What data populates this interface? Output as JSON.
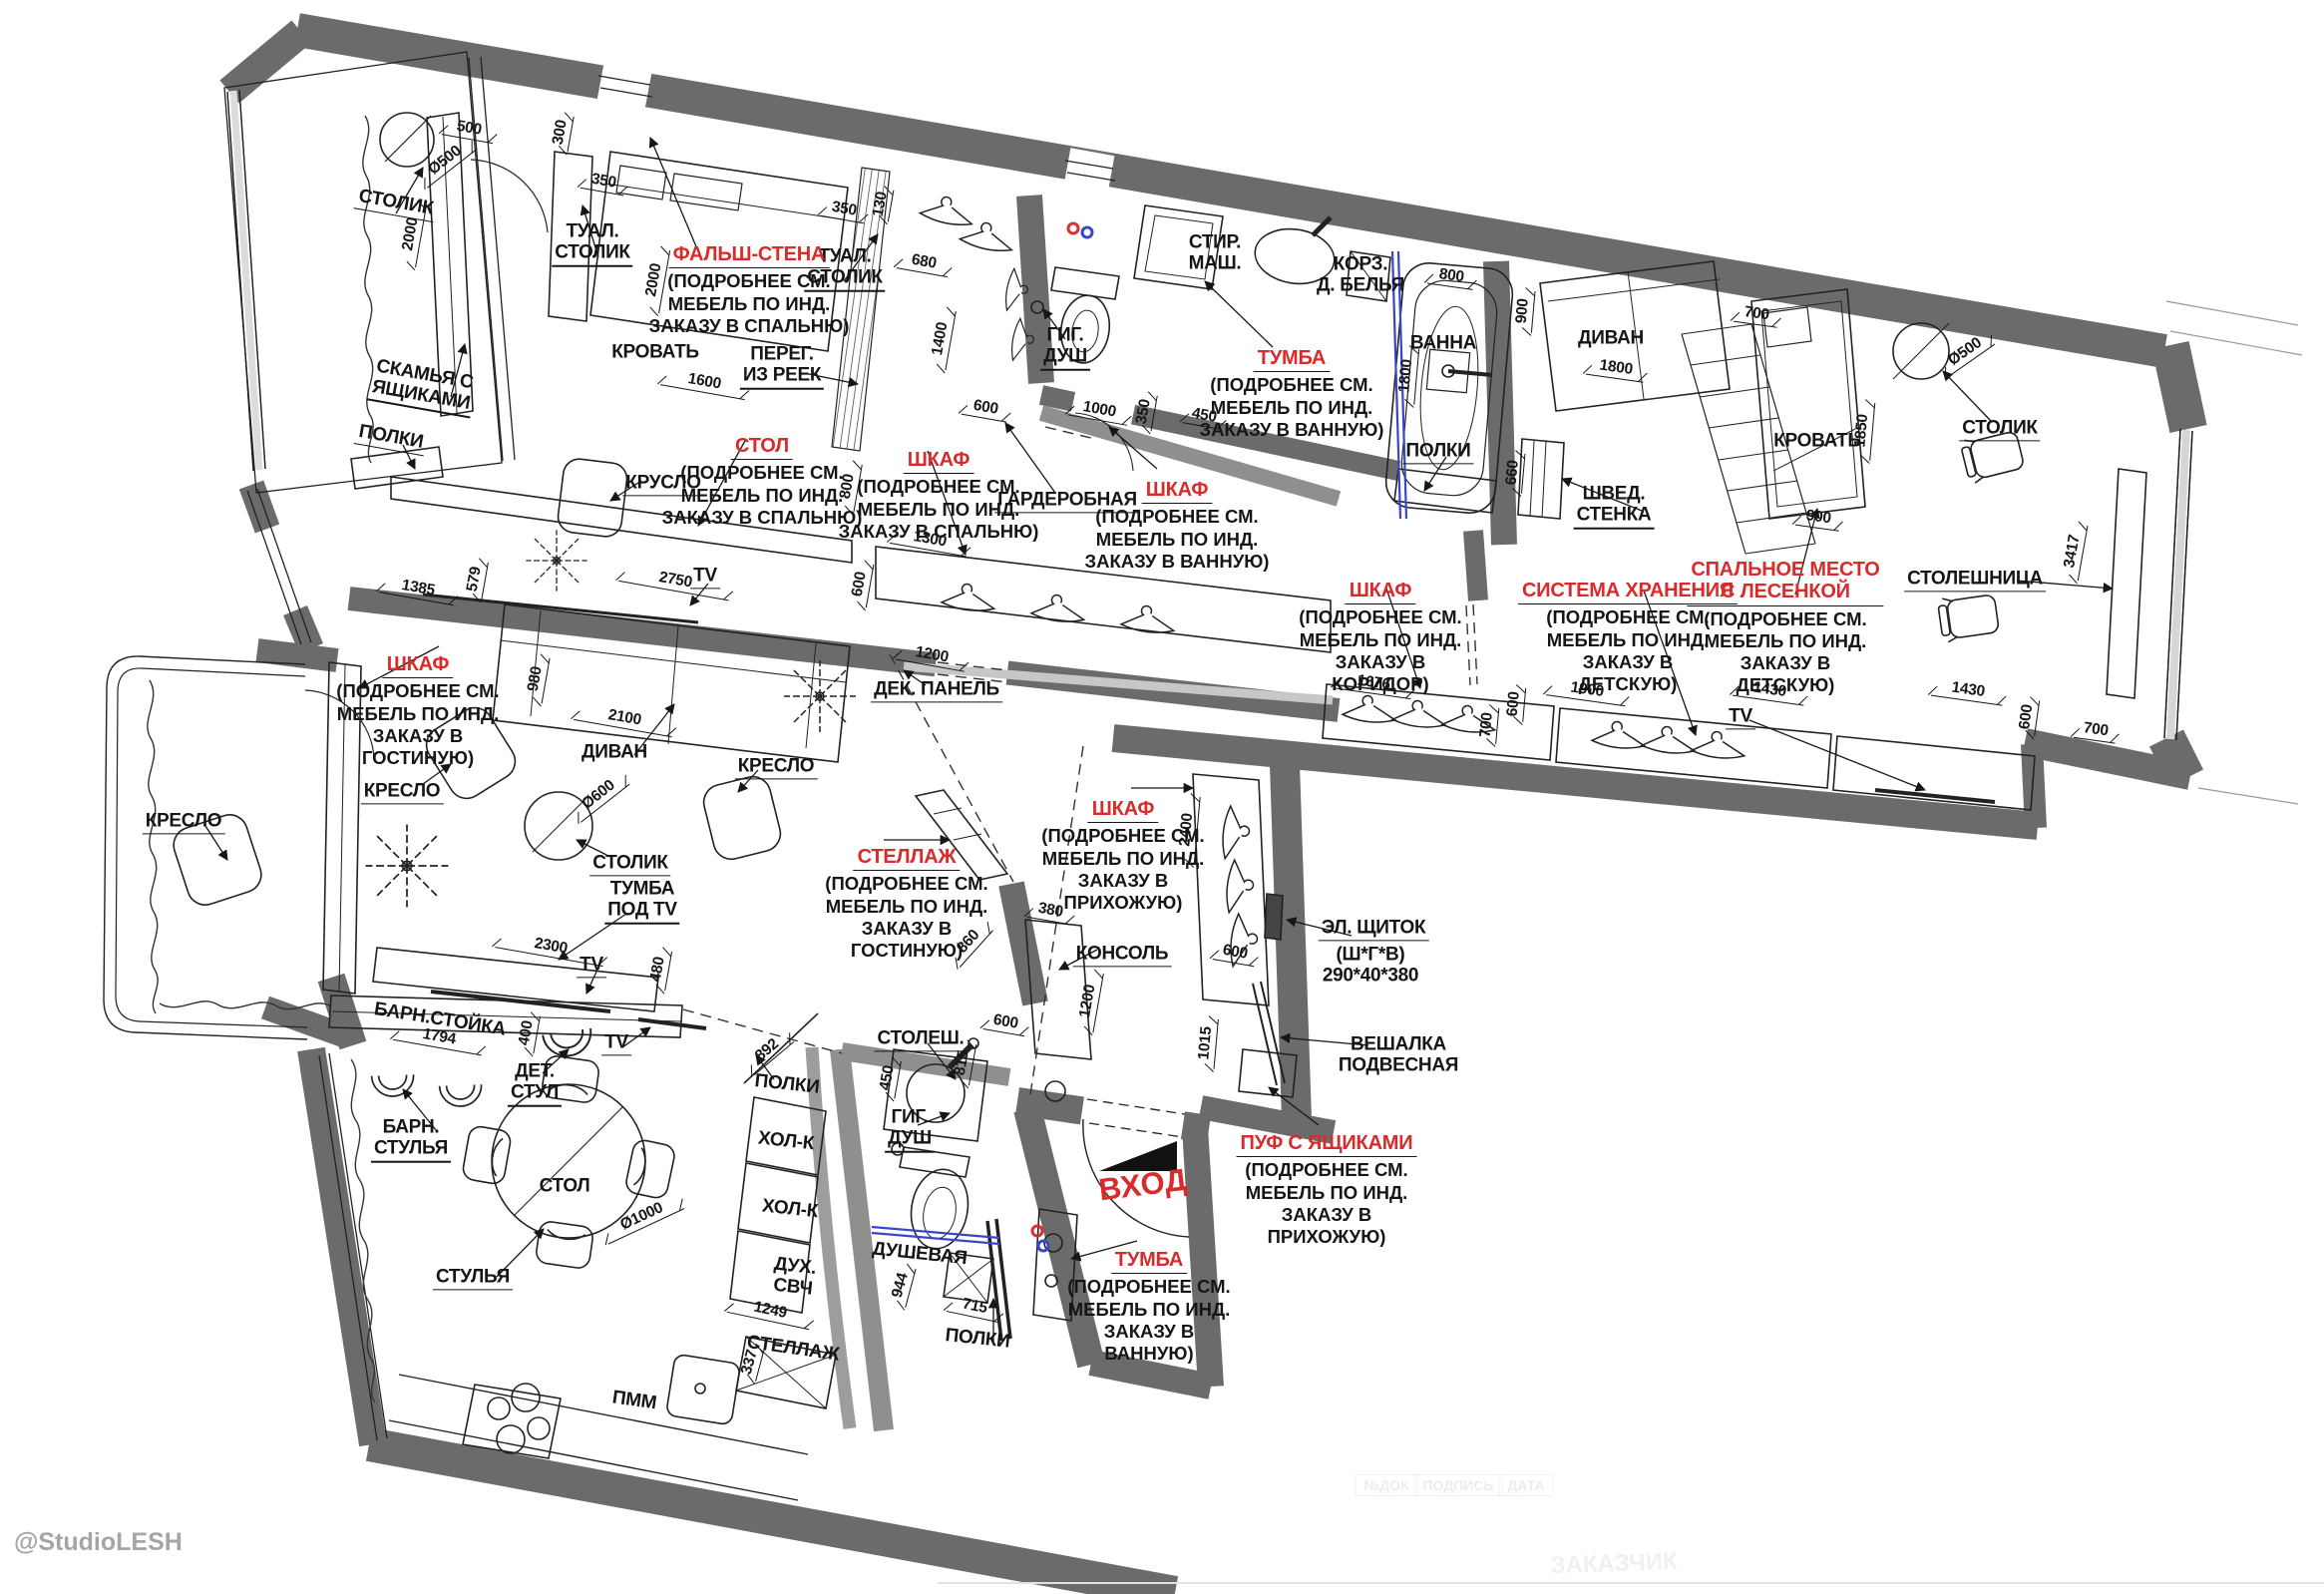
{
  "meta": {
    "credit": "@StudioLESH",
    "entrance": "ВХОД"
  },
  "colors": {
    "wall": "#6b6b6b",
    "wall_light": "#9d9d9d",
    "accent_red": "#d92b2b",
    "glass_blue": "#3a46c8",
    "ink": "#161616",
    "supply_red": "#d93030",
    "supply_blue": "#3a46c8"
  },
  "labels": [
    {
      "name": "balcony-table",
      "text": "СТОЛИК"
    },
    {
      "name": "bench-with-drawers",
      "text": "СКАМЬЯ С\nЯЩИКАМИ"
    },
    {
      "name": "balcony-shelves",
      "text": "ПОЛКИ"
    },
    {
      "name": "vanity-left",
      "text": "ТУАЛ.\nСТОЛИК"
    },
    {
      "name": "bed-main",
      "text": "КРОВАТЬ"
    },
    {
      "name": "slat-partition",
      "text": "ПЕРЕГ.\nИЗ РЕЕК"
    },
    {
      "name": "vanity-right",
      "text": "ТУАЛ.\nСТОЛИК"
    },
    {
      "name": "armchair-bedroom",
      "text": "КРУСЛО"
    },
    {
      "name": "tv-bedroom",
      "text": "TV"
    },
    {
      "name": "deco-panel",
      "text": "ДЕК. ПАНЕЛЬ"
    },
    {
      "name": "hyg-shower-top",
      "text": "ГИГ.\nДУШ"
    },
    {
      "name": "washing-machine",
      "text": "СТИР.\nМАШ."
    },
    {
      "name": "laundry-basket",
      "text": "КОРЗ.\nД. БЕЛЬЯ"
    },
    {
      "name": "bathtub",
      "text": "ВАННА"
    },
    {
      "name": "bath-shelves",
      "text": "ПОЛКИ"
    },
    {
      "name": "walk-in-closet",
      "text": "ГАРДЕРОБНАЯ"
    },
    {
      "name": "sofa-kids",
      "text": "ДИВАН"
    },
    {
      "name": "bed-kids",
      "text": "КРОВАТЬ"
    },
    {
      "name": "table-kids",
      "text": "СТОЛИК"
    },
    {
      "name": "swedish-wall",
      "text": "ШВЕД.\nСТЕНКА"
    },
    {
      "name": "desk-kids",
      "text": "СТОЛЕШНИЦА"
    },
    {
      "name": "tv-kids",
      "text": "TV"
    },
    {
      "name": "armchair-balcony",
      "text": "КРЕСЛО"
    },
    {
      "name": "armchair-living-left",
      "text": "КРЕСЛО"
    },
    {
      "name": "armchair-living-right",
      "text": "КРЕСЛО"
    },
    {
      "name": "sofa-living",
      "text": "ДИВАН"
    },
    {
      "name": "coffee-table",
      "text": "СТОЛИК"
    },
    {
      "name": "tv-stand",
      "text": "ТУМБА\nПОД TV"
    },
    {
      "name": "tv-living",
      "text": "TV"
    },
    {
      "name": "console",
      "text": "КОНСОЛЬ"
    },
    {
      "name": "counter-bath",
      "text": "СТОЛЕШ."
    },
    {
      "name": "hyg-shower-bottom",
      "text": "ГИГ.\nДУШ"
    },
    {
      "name": "el-panel-title",
      "text": "ЭЛ. ЩИТОК"
    },
    {
      "name": "el-panel-spec",
      "text": "(Ш*Г*В)\n290*40*380"
    },
    {
      "name": "wall-hanger",
      "text": "ВЕШАЛКА\nПОДВЕСНАЯ"
    },
    {
      "name": "bar-counter",
      "text": "БАРН.СТОЙКА"
    },
    {
      "name": "bar-stools",
      "text": "БАРН.\nСТУЛЬЯ"
    },
    {
      "name": "kids-chair",
      "text": "ДЕТ.\nСТУЛ"
    },
    {
      "name": "tv-kitchen",
      "text": "TV"
    },
    {
      "name": "dining-table",
      "text": "СТОЛ"
    },
    {
      "name": "chairs",
      "text": "СТУЛЬЯ"
    },
    {
      "name": "kitchen-shelves",
      "text": "ПОЛКИ"
    },
    {
      "name": "fridge-1",
      "text": "ХОЛ-К"
    },
    {
      "name": "fridge-2",
      "text": "ХОЛ-К"
    },
    {
      "name": "oven-microwave",
      "text": "ДУХ.\nСВЧ"
    },
    {
      "name": "rack-kitchen",
      "text": "СТЕЛЛАЖ"
    },
    {
      "name": "dishwasher",
      "text": "ПММ"
    },
    {
      "name": "shower-room",
      "text": "ДУШЕВАЯ"
    },
    {
      "name": "shower-shelves",
      "text": "ПОЛКИ"
    }
  ],
  "callouts": [
    {
      "title": "ФАЛЬШ-СТЕНА",
      "body": "(ПОДРОБНЕЕ СМ.\nМЕБЕЛЬ ПО ИНД.\nЗАКАЗУ В СПАЛЬНЮ)"
    },
    {
      "title": "СТОЛ",
      "body": "(ПОДРОБНЕЕ СМ.\nМЕБЕЛЬ ПО ИНД.\nЗАКАЗУ В СПАЛЬНЮ)"
    },
    {
      "title": "ШКАФ",
      "body": "(ПОДРОБНЕЕ СМ.\nМЕБЕЛЬ ПО ИНД.\nЗАКАЗУ В СПАЛЬНЮ)"
    },
    {
      "title": "ТУМБА",
      "body": "(ПОДРОБНЕЕ СМ.\nМЕБЕЛЬ ПО ИНД.\nЗАКАЗУ В ВАННУЮ)"
    },
    {
      "title": "ШКАФ",
      "body": "(ПОДРОБНЕЕ СМ.\nМЕБЕЛЬ ПО ИНД.\nЗАКАЗУ В ВАННУЮ)"
    },
    {
      "title": "ШКАФ",
      "body": "(ПОДРОБНЕЕ СМ.\nМЕБЕЛЬ ПО ИНД.\nЗАКАЗУ В\nГОСТИНУЮ)"
    },
    {
      "title": "СТЕЛЛАЖ",
      "body": "(ПОДРОБНЕЕ СМ.\nМЕБЕЛЬ ПО ИНД.\nЗАКАЗУ В\nГОСТИНУЮ)"
    },
    {
      "title": "ШКАФ",
      "body": "(ПОДРОБНЕЕ СМ.\nМЕБЕЛЬ ПО ИНД.\nЗАКАЗУ В\nКОРИДОР)"
    },
    {
      "title": "СИСТЕМА ХРАНЕНИЯ",
      "body": "(ПОДРОБНЕЕ СМ.\nМЕБЕЛЬ ПО ИНД.\nЗАКАЗУ В\nДЕТСКУЮ)"
    },
    {
      "title": "СПАЛЬНОЕ МЕСТО\nС ЛЕСЕНКОЙ",
      "body": "(ПОДРОБНЕЕ СМ.\nМЕБЕЛЬ ПО ИНД.\nЗАКАЗУ В\nДЕТСКУЮ)"
    },
    {
      "title": "ШКАФ",
      "body": "(ПОДРОБНЕЕ СМ.\nМЕБЕЛЬ ПО ИНД.\nЗАКАЗУ В\nПРИХОЖУЮ)"
    },
    {
      "title": "ПУФ С ЯЩИКАМИ",
      "body": "(ПОДРОБНЕЕ СМ.\nМЕБЕЛЬ ПО ИНД.\nЗАКАЗУ В\nПРИХОЖУЮ)"
    },
    {
      "title": "ТУМБА",
      "body": "(ПОДРОБНЕЕ СМ.\nМЕБЕЛЬ ПО ИНД.\nЗАКАЗУ В\nВАННУЮ)"
    }
  ],
  "dims": [
    "500",
    "Ø500",
    "300",
    "2000",
    "350",
    "2000",
    "1600",
    "350",
    "130",
    "680",
    "1400",
    "600",
    "800",
    "1300",
    "600",
    "2750",
    "1200",
    "1385",
    "579",
    "980",
    "2100",
    "Ø600",
    "2300",
    "480",
    "1794",
    "400",
    "Ø1000",
    "892",
    "1249",
    "337",
    "944",
    "715",
    "450",
    "815",
    "860",
    "380",
    "1200",
    "600",
    "2400",
    "1015",
    "600",
    "1000",
    "350",
    "450",
    "800",
    "900",
    "1800",
    "660",
    "1800",
    "700",
    "1850",
    "900",
    "Ø500",
    "3417",
    "1676",
    "700",
    "600",
    "1900",
    "1430",
    "1430",
    "600",
    "700"
  ],
  "titleblock": {
    "cell_1": "№ДОК",
    "cell_2": "ПОДПИСЬ",
    "cell_3": "ДАТА",
    "watermark": "ЗАКАЗЧИК"
  }
}
